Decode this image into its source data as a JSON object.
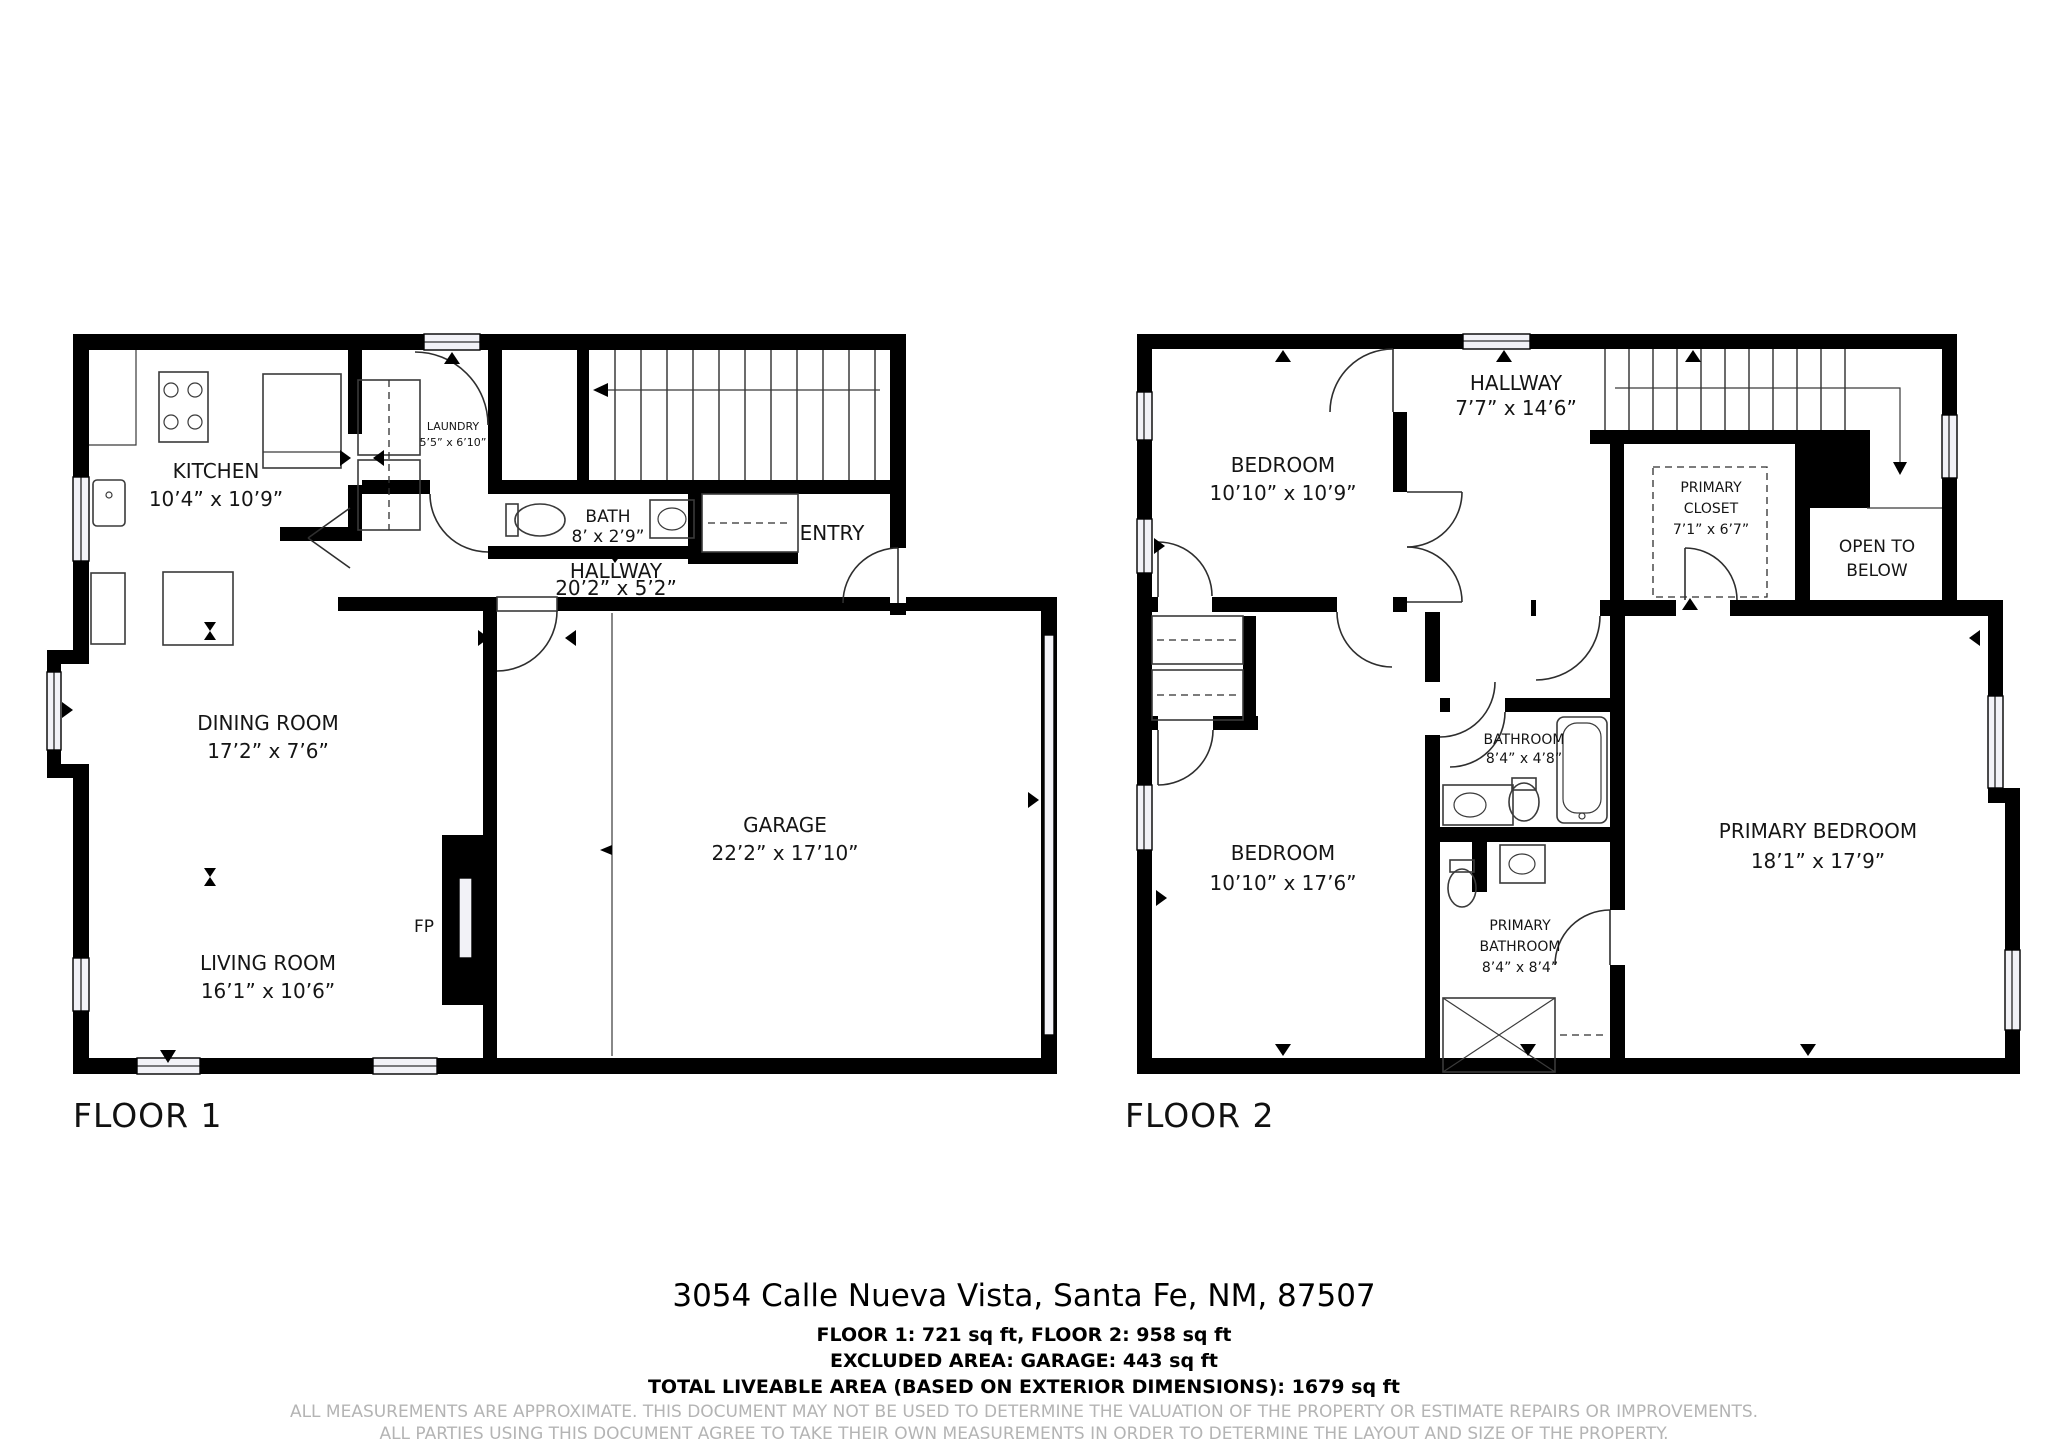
{
  "floor1": {
    "label": "FLOOR 1",
    "kitchen": {
      "name": "KITCHEN",
      "dims": "10’4” x 10’9”"
    },
    "laundry": {
      "name": "LAUNDRY",
      "dims": "5’5” x 6’10”"
    },
    "bath": {
      "name": "BATH",
      "dims": "8’ x 2’9”"
    },
    "hallway": {
      "name": "HALLWAY",
      "dims": "20’2” x 5’2”"
    },
    "entry": {
      "name": "ENTRY"
    },
    "dining": {
      "name": "DINING ROOM",
      "dims": "17’2” x 7’6”"
    },
    "living": {
      "name": "LIVING ROOM",
      "dims": "16’1” x 10’6”"
    },
    "fireplace": {
      "name": "FP"
    },
    "garage": {
      "name": "GARAGE",
      "dims": "22’2” x 17’10”"
    }
  },
  "floor2": {
    "label": "FLOOR 2",
    "bedroom1": {
      "name": "BEDROOM",
      "dims": "10’10” x 10’9”"
    },
    "hallway": {
      "name": "HALLWAY",
      "dims": "7’7” x 14’6”"
    },
    "primary_closet": {
      "line1": "PRIMARY",
      "line2": "CLOSET",
      "dims": "7’1” x 6’7”"
    },
    "open_below": {
      "line1": "OPEN TO",
      "line2": "BELOW"
    },
    "bathroom": {
      "name": "BATHROOM",
      "dims": "8’4” x 4’8”"
    },
    "bedroom2": {
      "name": "BEDROOM",
      "dims": "10’10” x 17’6”"
    },
    "primary_bathroom": {
      "line1": "PRIMARY",
      "line2": "BATHROOM",
      "dims": "8’4” x 8’4”"
    },
    "primary_bedroom": {
      "name": "PRIMARY BEDROOM",
      "dims": "18’1” x 17’9”"
    }
  },
  "footer": {
    "address": "3054 Calle Nueva Vista, Santa Fe, NM, 87507",
    "areas_line1": "FLOOR 1: 721 sq ft, FLOOR 2: 958 sq ft",
    "areas_line2": "EXCLUDED AREA: GARAGE: 443 sq ft",
    "areas_line3": "TOTAL LIVEABLE AREA (BASED ON EXTERIOR DIMENSIONS): 1679 sq ft",
    "disclaimer1": "ALL MEASUREMENTS ARE APPROXIMATE. THIS DOCUMENT MAY NOT BE USED TO DETERMINE THE VALUATION OF THE PROPERTY OR ESTIMATE REPAIRS OR IMPROVEMENTS.",
    "disclaimer2": "ALL PARTIES USING THIS DOCUMENT AGREE TO TAKE THEIR OWN MEASUREMENTS IN ORDER TO DETERMINE THE LAYOUT AND SIZE OF THE PROPERTY."
  }
}
